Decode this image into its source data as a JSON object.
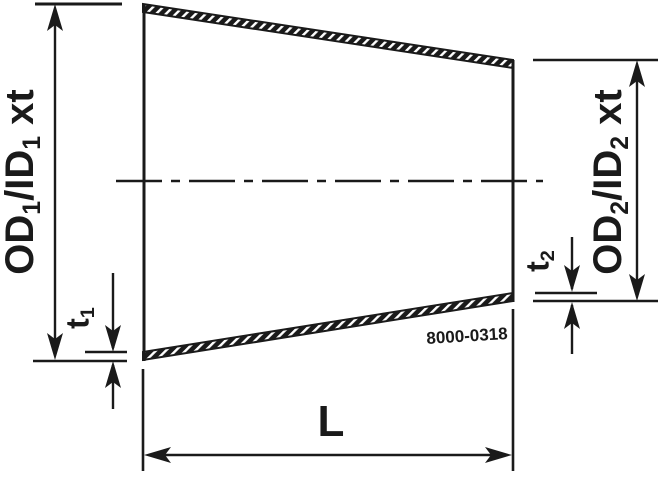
{
  "drawing": {
    "part_number": "8000-0318",
    "labels": {
      "od1": {
        "p1": "OD",
        "s1": "1",
        "p2": "/ID",
        "s2": "1",
        "p3": " xt"
      },
      "od2": {
        "p1": "OD",
        "s1": "2",
        "p2": "/ID",
        "s2": "2",
        "p3": " xt"
      },
      "t1": {
        "p": "t",
        "s": "1"
      },
      "t2": {
        "p": "t",
        "s": "2"
      },
      "length": "L"
    },
    "colors": {
      "ink": "#1a1a1a",
      "background": "#ffffff"
    }
  }
}
